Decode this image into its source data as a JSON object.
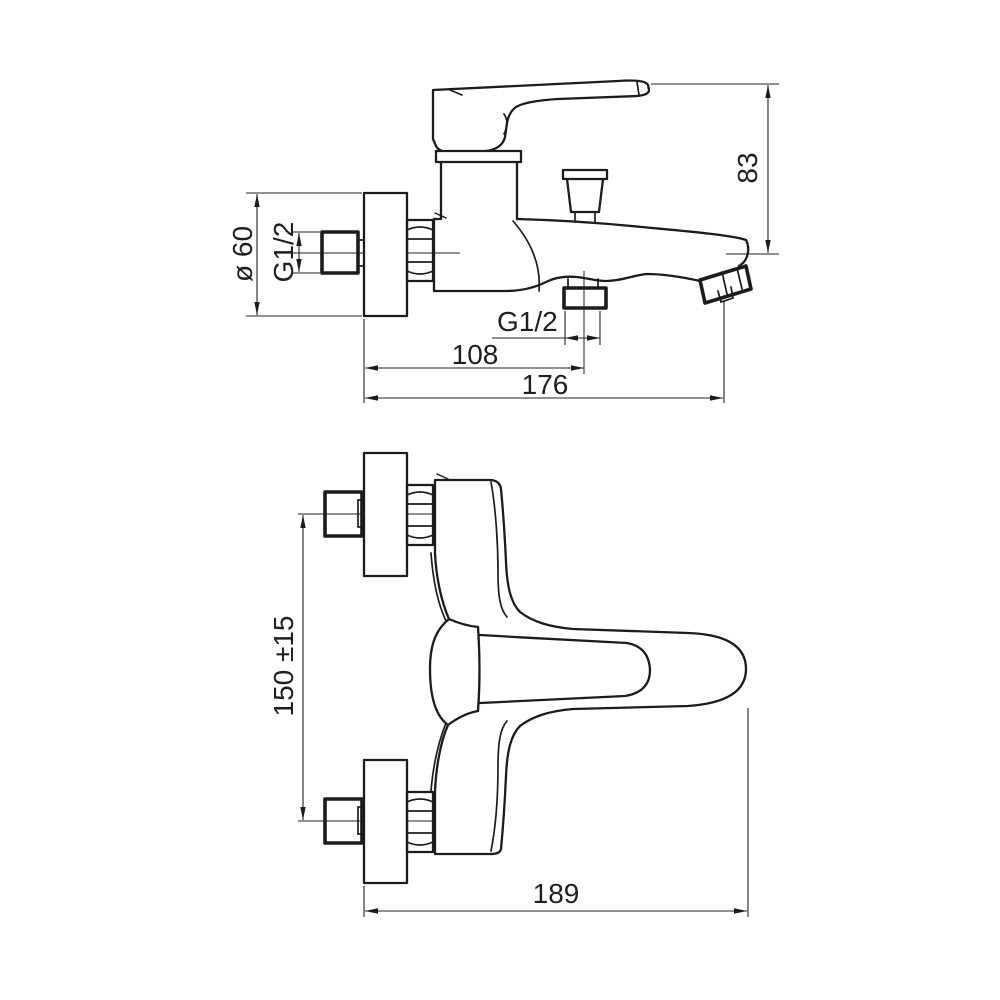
{
  "drawing": {
    "kind": "technical-dimensional-drawing",
    "product": "Wall-mounted single-lever bath shower mixer",
    "colors": {
      "line": "#1c1c1c",
      "background": "#ffffff"
    },
    "views": [
      {
        "id": "side",
        "name": "side-view"
      },
      {
        "id": "front",
        "name": "front-view"
      }
    ],
    "dimensions": {
      "side": {
        "spout_to_handle_height": "83",
        "escutcheon_diameter": "ø 60",
        "inlet_thread": "G1/2",
        "outlet_thread": "G1/2",
        "wall_to_outlet": "108",
        "wall_to_spout_tip": "176"
      },
      "front": {
        "inlet_centre_distance": "150 ±15",
        "overall_width": "189"
      }
    }
  }
}
